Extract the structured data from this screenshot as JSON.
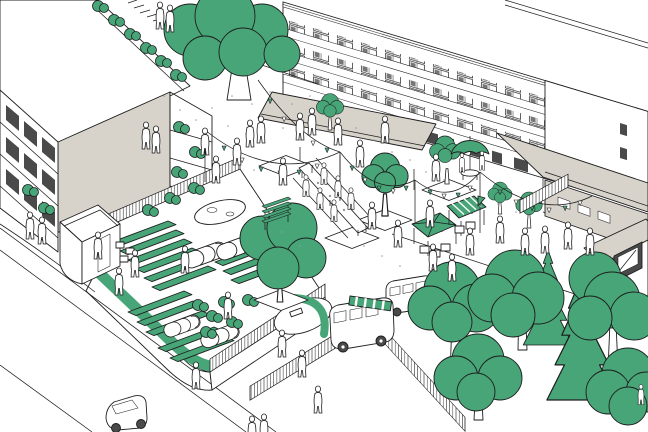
{
  "meta": {
    "description": "Hand-drawn axonometric illustration of a residential courtyard: community garden with raised beds and polytunnels, festival bunting, market stalls, food vans, large trees and surrounding apartment buildings",
    "style": "black line art with green and warm-gray accents"
  },
  "colors": {
    "background": "#ffffff",
    "outline": "#1e1e1e",
    "green": "#47a578",
    "gray": "#d7d3cb",
    "glass": "#4a4a4a",
    "dot_gray": "#9a9a9a",
    "wheel": "#333333"
  },
  "scene": {
    "buildings": [
      "flat-roof-block-left",
      "apartment-facade-left",
      "gallery-slab-top-right",
      "entrance-canopy",
      "long-canopy-right",
      "annex-right",
      "garden-pavilion"
    ],
    "vegetation": [
      "large-courtyard-tree",
      "garden-corner-tree",
      "tree-grove-bottom-right",
      "spruces",
      "raised-beds",
      "hedges",
      "parapet-shrubs"
    ],
    "garden": [
      "raised-beds",
      "polytunnels",
      "pond",
      "gabion-wall",
      "hedge",
      "fences"
    ],
    "street_furniture": [
      "bunting-strings",
      "market-stall-pyramid",
      "market-stall-striped",
      "louvre-stall",
      "parasol",
      "long-table",
      "benches",
      "crates"
    ],
    "vehicles": [
      "camper-van-food-truck",
      "minibus",
      "car-on-street"
    ],
    "figures": "many small outline pedestrians"
  }
}
